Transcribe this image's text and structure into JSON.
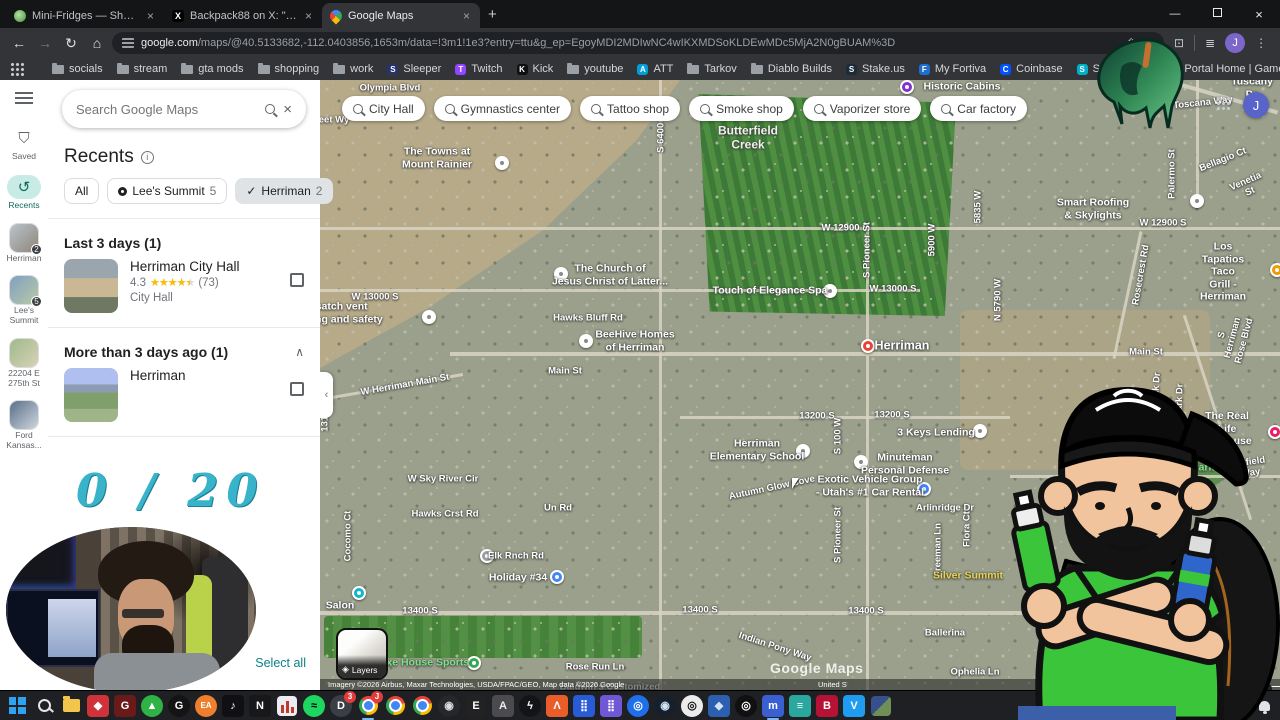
{
  "browser": {
    "tabs": [
      {
        "title": "Mini-Fridges — Shop — Freshe",
        "favicon": "plant",
        "active": false
      },
      {
        "title": "Backpack88 on X: \"To say I am t",
        "favicon": "x",
        "active": false
      },
      {
        "title": "Google Maps",
        "favicon": "maps",
        "active": true
      }
    ],
    "new_tab": "+",
    "url_host": "google.com",
    "url_path": "/maps/@40.5133682,-112.0403856,1653m/data=!3m1!1e3?entry=ttu&g_ep=EgoyMDI2MDIwNC4wIKXMDSoKLDEwMDc5MjA2N0gBUAM%3D",
    "profile_initial": "J",
    "all_bookmarks_label": "All Bookmarks",
    "bookmarks": [
      {
        "label": "socials",
        "kind": "folder"
      },
      {
        "label": "stream",
        "kind": "folder"
      },
      {
        "label": "gta mods",
        "kind": "folder"
      },
      {
        "label": "shopping",
        "kind": "folder"
      },
      {
        "label": "work",
        "kind": "folder"
      },
      {
        "label": "Sleeper",
        "kind": "site",
        "bg": "#27336b",
        "glyph": "S"
      },
      {
        "label": "Twitch",
        "kind": "site",
        "bg": "#9146ff",
        "glyph": "T"
      },
      {
        "label": "Kick",
        "kind": "site",
        "bg": "#0f0f0f",
        "glyph": "K"
      },
      {
        "label": "youtube",
        "kind": "folder"
      },
      {
        "label": "ATT",
        "kind": "site",
        "bg": "#009fdb",
        "glyph": "A"
      },
      {
        "label": "Tarkov",
        "kind": "folder"
      },
      {
        "label": "Diablo Builds",
        "kind": "folder"
      },
      {
        "label": "Stake.us",
        "kind": "site",
        "bg": "#1a2c38",
        "glyph": "S"
      },
      {
        "label": "My Fortiva",
        "kind": "site",
        "bg": "#1f6fd0",
        "glyph": "F"
      },
      {
        "label": "Coinbase",
        "kind": "site",
        "bg": "#0052ff",
        "glyph": "C"
      },
      {
        "label": "SoFi - Home",
        "kind": "site",
        "bg": "#00b0c8",
        "glyph": "S"
      },
      {
        "label": "Portal Home | Game...",
        "kind": "site",
        "bg": "#c23a2e",
        "glyph": "◆"
      },
      {
        "label": "Concora Credit",
        "kind": "site",
        "bg": "#2b6fd4",
        "glyph": "C"
      }
    ]
  },
  "sidebar": {
    "search_placeholder": "Search Google Maps",
    "recents_title": "Recents",
    "filter_chips": [
      {
        "label": "All"
      },
      {
        "label": "Lee's Summit",
        "count": "5",
        "icon": "pin"
      },
      {
        "label": "Herriman",
        "count": "2",
        "icon": "check",
        "selected": true
      }
    ],
    "sections": [
      {
        "title": "Last 3 days (1)",
        "chevron": "",
        "items": [
          {
            "title": "Herriman City Hall",
            "rating": "4.3",
            "stars_pct": "90%",
            "reviews": "(73)",
            "category": "City Hall",
            "thumb": "cityhall"
          }
        ]
      },
      {
        "title": "More than 3 days ago (1)",
        "chevron": "∧",
        "items": [
          {
            "title": "Herriman",
            "thumb": "valley"
          }
        ]
      }
    ],
    "select_all_label": "Select all",
    "get_app_label": "Get",
    "rail": [
      {
        "label": "Saved",
        "icon": "bookmark"
      },
      {
        "label": "Recents",
        "icon": "history",
        "active": true
      },
      {
        "label": "Herriman",
        "thumb": "t1",
        "badge": "2"
      },
      {
        "label": "Lee's\nSummit",
        "thumb": "t2",
        "badge": "5"
      },
      {
        "label": "22204 E\n275th St",
        "thumb": "t3"
      },
      {
        "label": "Ford\nKansas...",
        "thumb": "t4"
      }
    ]
  },
  "map": {
    "search_chips": [
      "City Hall",
      "Gymnastics center",
      "Tattoo shop",
      "Smoke shop",
      "Vaporizer store",
      "Car factory"
    ],
    "layers_label": "Layers",
    "watermark": "Google Maps",
    "attribution": "Imagery ©2026 Airbus, Maxar Technologies, USDA/FPAC/GEO, Map data ©2026 Google",
    "attribution_region": "United S",
    "attribution_feedback": "eedback",
    "scale_label": "500 ft",
    "zoom_in": "+",
    "zoom_out": "−",
    "collapse_glyph": "‹",
    "labels": [
      {
        "t": "Olympia Blvd",
        "x": 70,
        "y": 8,
        "k": "road"
      },
      {
        "t": "eet Wy",
        "x": 14,
        "y": 40,
        "k": "road"
      },
      {
        "t": "Butterfield\nCreek",
        "x": 428,
        "y": 58,
        "k": "area"
      },
      {
        "t": "Historic Cabins",
        "x": 642,
        "y": 7,
        "k": "poi"
      },
      {
        "t": "The Towns at\nMount Rainier",
        "x": 117,
        "y": 78,
        "k": "poi"
      },
      {
        "t": "S 6400 W",
        "x": 341,
        "y": 52,
        "k": "road",
        "r": -90
      },
      {
        "t": "Smart Roofing\n& Skylights",
        "x": 773,
        "y": 129,
        "k": "poi"
      },
      {
        "t": "W 12900 S",
        "x": 525,
        "y": 148,
        "k": "road"
      },
      {
        "t": "W 12900 S",
        "x": 843,
        "y": 143,
        "k": "road"
      },
      {
        "t": "The Church of\nJesus Christ of Latter...",
        "x": 290,
        "y": 195,
        "k": "poi"
      },
      {
        "t": "W 13000 S",
        "x": 55,
        "y": 217,
        "k": "road"
      },
      {
        "t": "W 13000 S",
        "x": 573,
        "y": 209,
        "k": "road"
      },
      {
        "t": "Wasatch vent\ncleaning and safety",
        "x": 14,
        "y": 233,
        "k": "poi"
      },
      {
        "t": "Hawks Bluff Rd",
        "x": 268,
        "y": 238,
        "k": "road"
      },
      {
        "t": "Touch of Elegance Spa",
        "x": 450,
        "y": 211,
        "k": "poi"
      },
      {
        "t": "BeeHive Homes\nof Herriman",
        "x": 315,
        "y": 261,
        "k": "poi"
      },
      {
        "t": "Herriman",
        "x": 582,
        "y": 266,
        "k": "city"
      },
      {
        "t": "Main St",
        "x": 245,
        "y": 291,
        "k": "road"
      },
      {
        "t": "Main St",
        "x": 826,
        "y": 272,
        "k": "road"
      },
      {
        "t": "W Herriman Main St",
        "x": 85,
        "y": 305,
        "k": "road",
        "r": -10
      },
      {
        "t": "S Pioneer St",
        "x": 547,
        "y": 170,
        "k": "road",
        "r": -90
      },
      {
        "t": "S Pioneer St",
        "x": 518,
        "y": 455,
        "k": "road",
        "r": -90
      },
      {
        "t": "5900 W",
        "x": 612,
        "y": 160,
        "k": "road",
        "r": -90
      },
      {
        "t": "5835 W",
        "x": 658,
        "y": 127,
        "k": "road",
        "r": -90
      },
      {
        "t": "N 5790 W",
        "x": 678,
        "y": 220,
        "k": "road",
        "r": -90
      },
      {
        "t": "Rosecrest Rd",
        "x": 821,
        "y": 195,
        "k": "road",
        "r": -80
      },
      {
        "t": "Los Tapatios Taco\nGrill - Herriman",
        "x": 903,
        "y": 192,
        "k": "poi"
      },
      {
        "t": "Toscana Way",
        "x": 883,
        "y": 23,
        "k": "road",
        "r": -6
      },
      {
        "t": "Tuscany Pa",
        "x": 932,
        "y": 8,
        "k": "poi"
      },
      {
        "t": "Palermo St",
        "x": 852,
        "y": 94,
        "k": "road",
        "r": -90
      },
      {
        "t": "Bellagio Ct",
        "x": 903,
        "y": 80,
        "k": "road",
        "r": -22
      },
      {
        "t": "Venetia St",
        "x": 928,
        "y": 107,
        "k": "road",
        "r": -24
      },
      {
        "t": "S Herriman Rose Blvd",
        "x": 913,
        "y": 258,
        "k": "road",
        "r": -75
      },
      {
        "t": "Eagle Peak Dr",
        "x": 835,
        "y": 324,
        "k": "road",
        "r": -85
      },
      {
        "t": "S Woods Park Dr",
        "x": 859,
        "y": 342,
        "k": "road",
        "r": -88
      },
      {
        "t": "The Real Life\nUP House",
        "x": 907,
        "y": 349,
        "k": "poi"
      },
      {
        "t": "HOA Park",
        "x": 870,
        "y": 388,
        "k": "green"
      },
      {
        "t": "Anfield Way",
        "x": 930,
        "y": 388,
        "k": "road",
        "r": -8
      },
      {
        "t": "13200 S",
        "x": 497,
        "y": 336,
        "k": "road"
      },
      {
        "t": "13200 S",
        "x": 572,
        "y": 335,
        "k": "road"
      },
      {
        "t": "3 Keys Lending",
        "x": 616,
        "y": 353,
        "k": "poi"
      },
      {
        "t": "Minuteman\nPersonal Defense",
        "x": 585,
        "y": 384,
        "k": "poi"
      },
      {
        "t": "Exotic Vehicle Group\n- Utah's #1 Car Rental",
        "x": 550,
        "y": 406,
        "k": "poi"
      },
      {
        "t": "Arlinridge Dr",
        "x": 625,
        "y": 428,
        "k": "road"
      },
      {
        "t": "Autumn Glow Cove",
        "x": 452,
        "y": 408,
        "k": "road",
        "r": -12
      },
      {
        "t": "S 100 W",
        "x": 518,
        "y": 356,
        "k": "road",
        "r": -90
      },
      {
        "t": "Freeman Ln",
        "x": 618,
        "y": 470,
        "k": "road",
        "r": -90
      },
      {
        "t": "Flora Ct",
        "x": 647,
        "y": 449,
        "k": "road",
        "r": -90
      },
      {
        "t": "Silver Summit",
        "x": 648,
        "y": 496,
        "k": "yellow"
      },
      {
        "t": "Herriman\nElementary School",
        "x": 437,
        "y": 370,
        "k": "poi"
      },
      {
        "t": "W Sky River Cir",
        "x": 123,
        "y": 399,
        "k": "road"
      },
      {
        "t": "Hawks Crst Rd",
        "x": 125,
        "y": 434,
        "k": "road"
      },
      {
        "t": "Elk Rnch Rd",
        "x": 196,
        "y": 476,
        "k": "road"
      },
      {
        "t": "Un Rd",
        "x": 238,
        "y": 428,
        "k": "road"
      },
      {
        "t": "Holiday #34",
        "x": 198,
        "y": 498,
        "k": "poi"
      },
      {
        "t": "13175 S",
        "x": 5,
        "y": 334,
        "k": "road",
        "r": -90
      },
      {
        "t": "Cocomo Ct",
        "x": 28,
        "y": 456,
        "k": "road",
        "r": -90
      },
      {
        "t": "Salon",
        "x": 20,
        "y": 526,
        "k": "poi"
      },
      {
        "t": "13400 S",
        "x": 100,
        "y": 531,
        "k": "road"
      },
      {
        "t": "13400 S",
        "x": 380,
        "y": 530,
        "k": "road"
      },
      {
        "t": "13400 S",
        "x": 546,
        "y": 531,
        "k": "road"
      },
      {
        "t": "13400 S",
        "x": 797,
        "y": 529,
        "k": "road"
      },
      {
        "t": "Indian Pony Way",
        "x": 455,
        "y": 567,
        "k": "road",
        "r": 18
      },
      {
        "t": "Rose Run Ln",
        "x": 275,
        "y": 587,
        "k": "road"
      },
      {
        "t": "Axe House Sports",
        "x": 104,
        "y": 583,
        "k": "green"
      },
      {
        "t": "Baldwin's Customized",
        "x": 290,
        "y": 607,
        "k": "road"
      },
      {
        "t": "Ballerina",
        "x": 625,
        "y": 553,
        "k": "road"
      },
      {
        "t": "Ophelia Ln",
        "x": 655,
        "y": 592,
        "k": "road"
      }
    ],
    "markers": [
      {
        "x": 182,
        "y": 83,
        "c": "white"
      },
      {
        "x": 587,
        "y": 7,
        "c": "purple"
      },
      {
        "x": 877,
        "y": 121,
        "c": "white"
      },
      {
        "x": 241,
        "y": 194,
        "c": "white"
      },
      {
        "x": 109,
        "y": 237,
        "c": "white"
      },
      {
        "x": 510,
        "y": 211,
        "c": "white"
      },
      {
        "x": 266,
        "y": 261,
        "c": "white"
      },
      {
        "x": 548,
        "y": 266,
        "c": "red"
      },
      {
        "x": 660,
        "y": 351,
        "c": "white"
      },
      {
        "x": 541,
        "y": 382,
        "c": "white"
      },
      {
        "x": 604,
        "y": 409,
        "c": "blue"
      },
      {
        "x": 957,
        "y": 190,
        "c": "orange"
      },
      {
        "x": 237,
        "y": 497,
        "c": "blue"
      },
      {
        "x": 154,
        "y": 583,
        "c": "green"
      },
      {
        "x": 39,
        "y": 513,
        "c": "teal"
      },
      {
        "x": 167,
        "y": 476,
        "c": "gray"
      },
      {
        "x": 483,
        "y": 371,
        "c": "white"
      },
      {
        "x": 955,
        "y": 352,
        "c": "pink"
      }
    ],
    "roads": [
      {
        "x": 0,
        "y": 147,
        "w": 960,
        "h": 3
      },
      {
        "x": 0,
        "y": 209,
        "w": 600,
        "h": 3
      },
      {
        "x": 130,
        "y": 272,
        "w": 830,
        "h": 4
      },
      {
        "x": -6,
        "y": 306,
        "w": 150,
        "h": 3,
        "r": -10
      },
      {
        "x": 360,
        "y": 336,
        "w": 330,
        "h": 3
      },
      {
        "x": 0,
        "y": 531,
        "w": 960,
        "h": 4
      },
      {
        "x": 339,
        "y": 0,
        "w": 3,
        "h": 610
      },
      {
        "x": 546,
        "y": 147,
        "w": 3,
        "h": 463
      },
      {
        "x": 876,
        "y": 0,
        "w": 3,
        "h": 120
      },
      {
        "x": 806,
        "y": 150,
        "w": 3,
        "h": 130,
        "r": 12
      },
      {
        "x": 896,
        "y": 230,
        "w": 3,
        "h": 215,
        "r": -18
      },
      {
        "x": 840,
        "y": 14,
        "w": 120,
        "h": 4,
        "r": 16
      },
      {
        "x": 690,
        "y": 395,
        "w": 270,
        "h": 3
      }
    ]
  },
  "overlay": {
    "counter": "0 / 20"
  },
  "taskbar": {
    "icons": [
      {
        "name": "windows-start",
        "type": "start"
      },
      {
        "name": "windows-search",
        "type": "search"
      },
      {
        "name": "file-explorer",
        "type": "folder"
      },
      {
        "name": "firebot-app",
        "bg": "#cf3339",
        "glyph": "◆",
        "fg": "#fff"
      },
      {
        "name": "g-app",
        "bg": "#6b1a1a",
        "glyph": "G",
        "fg": "#fff"
      },
      {
        "name": "green-launcher",
        "bg": "#2fb344",
        "glyph": "▲",
        "fg": "#fff",
        "round": true
      },
      {
        "name": "logitech-g-hub",
        "bg": "#141414",
        "glyph": "G",
        "fg": "#fff",
        "round": true
      },
      {
        "name": "ea-app",
        "bg": "#ee7f2d",
        "glyph": "EA",
        "fg": "#fff",
        "round": true
      },
      {
        "name": "tiktok",
        "bg": "#101014",
        "glyph": "♪",
        "fg": "#fff"
      },
      {
        "name": "notepad-app",
        "bg": "#18181b",
        "glyph": "N",
        "fg": "#fff"
      },
      {
        "name": "stats-app",
        "type": "bars"
      },
      {
        "name": "spotify",
        "bg": "#1ed760",
        "glyph": "≈",
        "fg": "#000",
        "round": true
      },
      {
        "name": "discord",
        "bg": "#3b3e45",
        "glyph": "D",
        "fg": "#fff",
        "round": true,
        "badge": "3"
      },
      {
        "name": "chrome-profile-1",
        "type": "chrome",
        "active": true,
        "badge": "J"
      },
      {
        "name": "chrome-profile-2",
        "type": "chrome"
      },
      {
        "name": "chrome-profile-3",
        "type": "chrome"
      },
      {
        "name": "dark-app",
        "bg": "#26262b",
        "glyph": "◉",
        "fg": "#ddd",
        "round": true
      },
      {
        "name": "epic-games",
        "bg": "#222222",
        "glyph": "E",
        "fg": "#fff"
      },
      {
        "name": "armoury-crate",
        "bg": "#4a4a4f",
        "glyph": "A",
        "fg": "#eee"
      },
      {
        "name": "bolt-app",
        "bg": "#141418",
        "glyph": "ϟ",
        "fg": "#fff",
        "round": true
      },
      {
        "name": "lambda-app",
        "bg": "#e85d2a",
        "glyph": "Λ",
        "fg": "#fff"
      },
      {
        "name": "grid-app-blue",
        "bg": "#2a5bd7",
        "glyph": "⣿",
        "fg": "#fff"
      },
      {
        "name": "grid-app-purple",
        "bg": "#6f57d6",
        "glyph": "⣿",
        "fg": "#fff"
      },
      {
        "name": "blue-round-app",
        "bg": "#1f6feb",
        "glyph": "◎",
        "fg": "#fff",
        "round": true
      },
      {
        "name": "steam",
        "bg": "#16202d",
        "glyph": "◉",
        "fg": "#cfe3f5",
        "round": true
      },
      {
        "name": "steelseries-gg",
        "bg": "#ececec",
        "glyph": "◎",
        "fg": "#111",
        "round": true
      },
      {
        "name": "shield-app",
        "bg": "#2d5fb0",
        "glyph": "◆",
        "fg": "#cfe3f5"
      },
      {
        "name": "obs-studio",
        "bg": "#101010",
        "glyph": "◎",
        "fg": "#fff",
        "round": true
      },
      {
        "name": "mixitup-app",
        "bg": "#3a5fd0",
        "glyph": "m",
        "fg": "#fff",
        "active": true
      },
      {
        "name": "list-app",
        "bg": "#2aa79e",
        "glyph": "≡",
        "fg": "#fff"
      },
      {
        "name": "database-app",
        "bg": "#b51236",
        "glyph": "B",
        "fg": "#fff"
      },
      {
        "name": "vs-code",
        "bg": "#1f9cf0",
        "glyph": "V",
        "fg": "#fff"
      },
      {
        "name": "photo-app",
        "type": "photo"
      }
    ],
    "tray_time": "8:12 PM",
    "tray_date": "2/6/2026"
  }
}
